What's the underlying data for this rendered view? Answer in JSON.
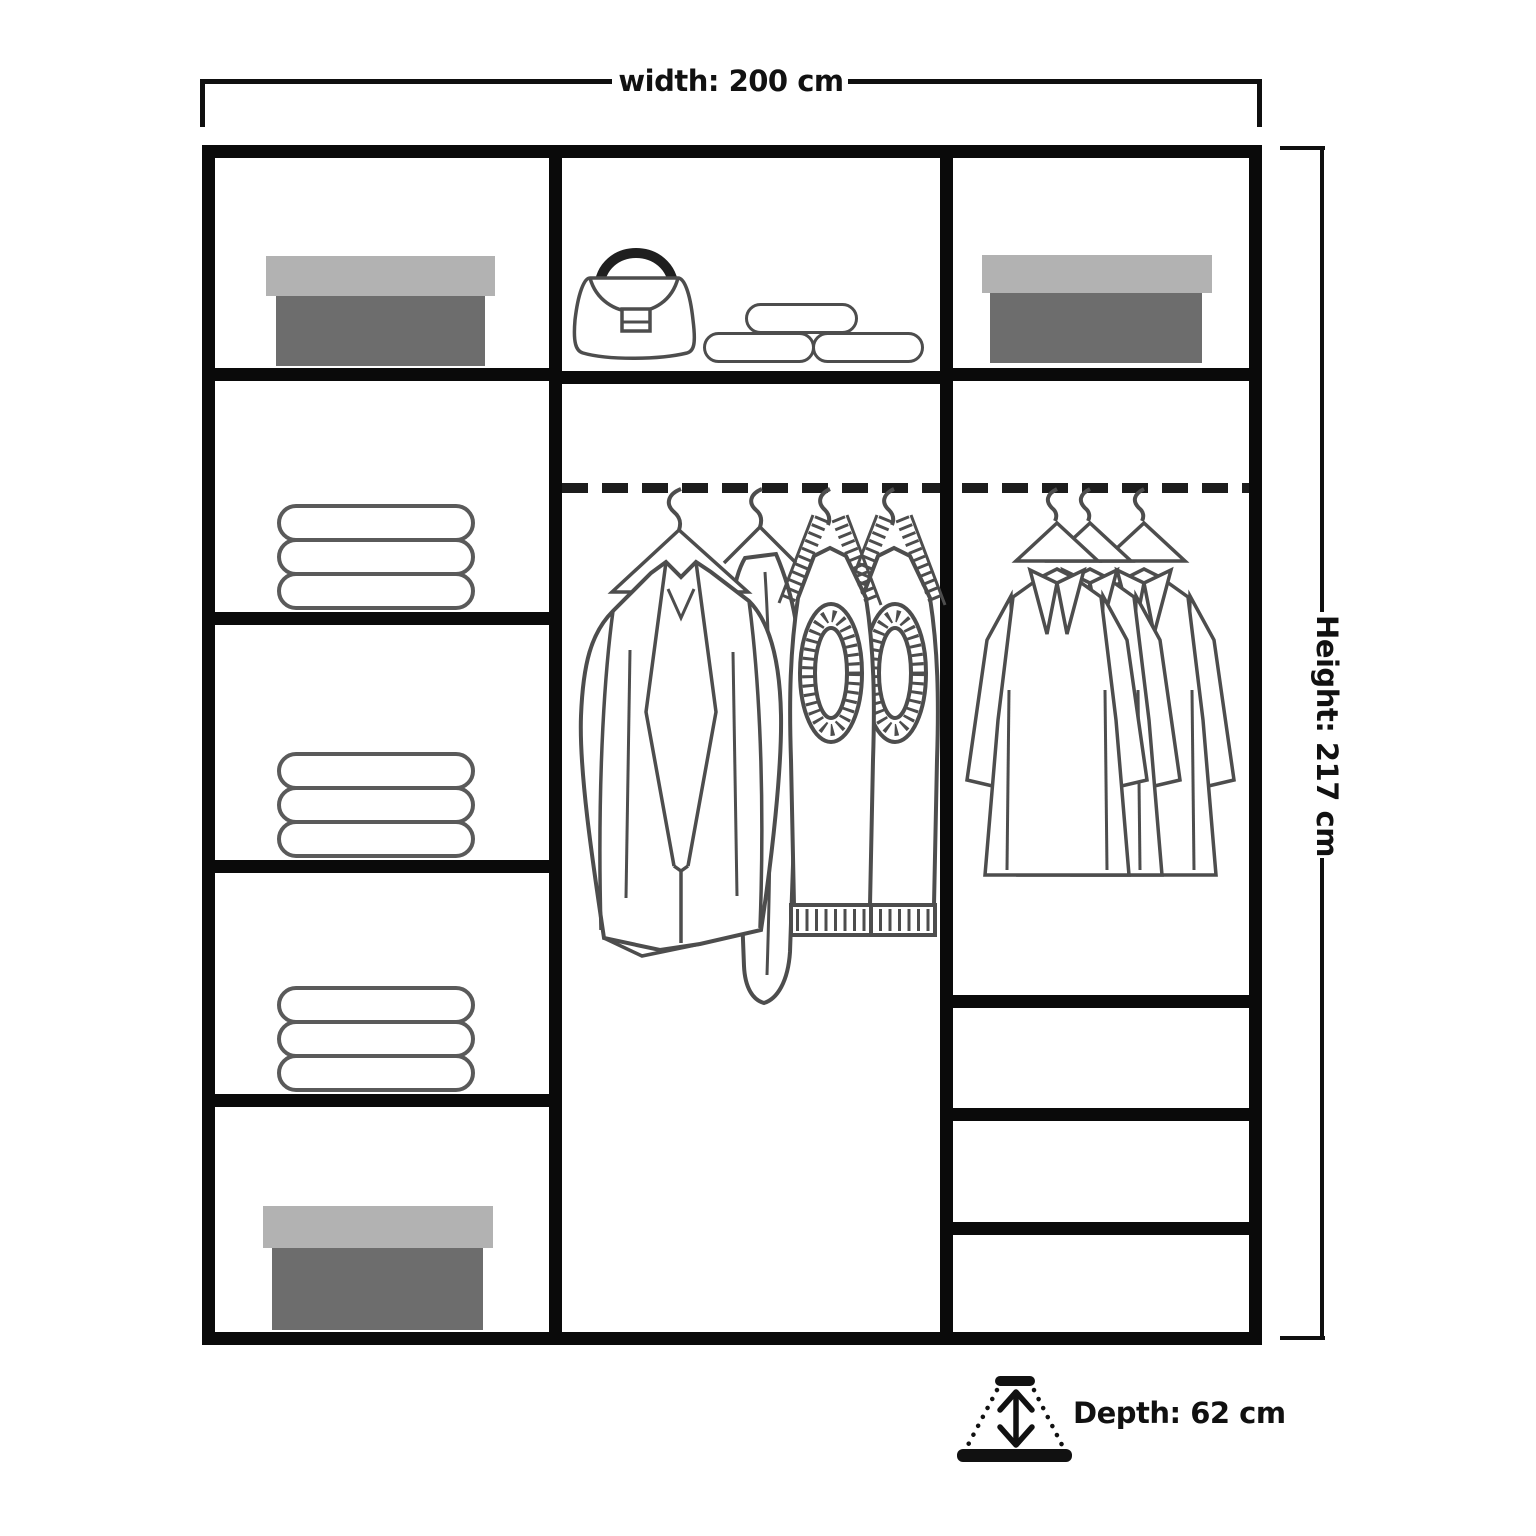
{
  "labels": {
    "width": "width: 200 cm",
    "height": "Height: 217 cm",
    "depth": "Depth: 62 cm"
  },
  "dimensions": {
    "width_cm": 200,
    "height_cm": 217,
    "depth_cm": 62
  },
  "colors": {
    "frame": "#0a0a0a",
    "line_art": "#4d4d4d",
    "box_lid": "#b2b2b2",
    "box_body": "#6d6d6d",
    "rail": "#1c1c1c",
    "text": "#111111",
    "background": "#ffffff"
  },
  "wardrobe": {
    "left_column": {
      "cells": [
        "storage box",
        "folded linen stack",
        "folded linen stack",
        "folded linen stack",
        "storage box"
      ]
    },
    "middle_column": {
      "cells": [
        "top shelf with handbag and folded clothes",
        "hanging rail with coat, dress and knitwear"
      ]
    },
    "right_column": {
      "cells": [
        "storage box",
        "hanging rail with shirts",
        "drawer",
        "drawer",
        "drawer"
      ]
    }
  },
  "icons": [
    "storage-box-icon",
    "folded-linen-icon",
    "handbag-icon",
    "folded-clothes-icon",
    "hanging-rail",
    "hanging-clothes-icon",
    "hanging-shirts-icon",
    "depth-range-icon"
  ]
}
